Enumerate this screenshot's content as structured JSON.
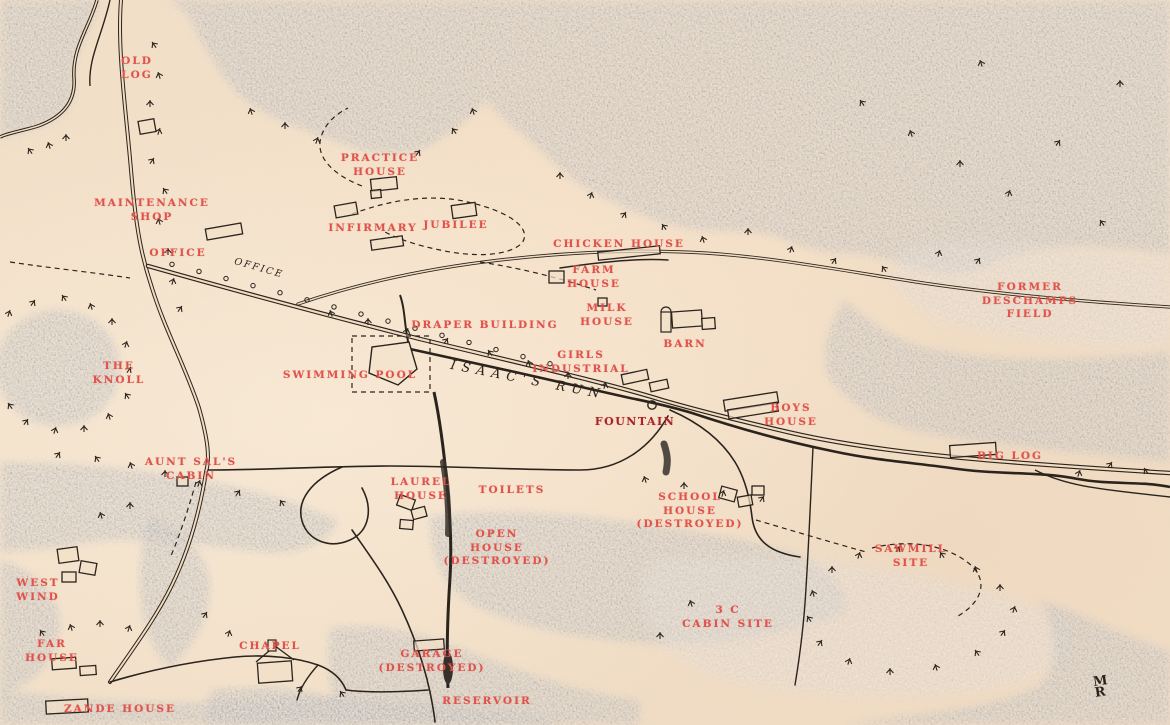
{
  "map": {
    "description": "hand-drawn settlement site map with red place labels",
    "colors": {
      "paper": "#f1dcc2",
      "forest_dark": "#8a8784",
      "forest_light": "#b9ab9c",
      "ink": "#2b241d",
      "label_red": "#e0524b",
      "strong_red": "#a8232a"
    },
    "labels": [
      {
        "text": "OLD\nLOG",
        "x": 137,
        "y": 55
      },
      {
        "text": "MAINTENANCE\nSHOP",
        "x": 152,
        "y": 197
      },
      {
        "text": "OFFICE",
        "x": 178,
        "y": 247
      },
      {
        "text": "PRACTICE\nHOUSE",
        "x": 380,
        "y": 152
      },
      {
        "text": "INFIRMARY",
        "x": 373,
        "y": 222
      },
      {
        "text": "JUBILEE",
        "x": 456,
        "y": 219
      },
      {
        "text": "CHICKEN HOUSE",
        "x": 619,
        "y": 238
      },
      {
        "text": "FARM\nHOUSE",
        "x": 594,
        "y": 264
      },
      {
        "text": "MILK\nHOUSE",
        "x": 607,
        "y": 302
      },
      {
        "text": "BARN",
        "x": 685,
        "y": 338
      },
      {
        "text": "FORMER\nDESCHAMPS\nFIELD",
        "x": 1030,
        "y": 281
      },
      {
        "text": "DRAPER BUILDING",
        "x": 485,
        "y": 319
      },
      {
        "text": "SWIMMING POOL",
        "x": 350,
        "y": 369
      },
      {
        "text": "GIRLS\nINDUSTRIAL",
        "x": 581,
        "y": 349
      },
      {
        "text": "THE\nKNOLL",
        "x": 119,
        "y": 360
      },
      {
        "text": "FOUNTAIN",
        "x": 635,
        "y": 415,
        "style": "strong"
      },
      {
        "text": "BOYS\nHOUSE",
        "x": 791,
        "y": 402
      },
      {
        "text": "BIG LOG",
        "x": 1010,
        "y": 450
      },
      {
        "text": "AUNT SAL'S\nCABIN",
        "x": 191,
        "y": 456
      },
      {
        "text": "LAUREL\nHOUSE",
        "x": 421,
        "y": 476
      },
      {
        "text": "TOILETS",
        "x": 512,
        "y": 484
      },
      {
        "text": "SCHOOL\nHOUSE\n(DESTROYED)",
        "x": 690,
        "y": 491
      },
      {
        "text": "OPEN\nHOUSE\n(DESTROYED)",
        "x": 497,
        "y": 528
      },
      {
        "text": "WEST\nWIND",
        "x": 38,
        "y": 577
      },
      {
        "text": "SAWMILL\nSITE",
        "x": 911,
        "y": 543
      },
      {
        "text": "3 C\nCABIN SITE",
        "x": 728,
        "y": 604
      },
      {
        "text": "FAR\nHOUSE",
        "x": 52,
        "y": 638
      },
      {
        "text": "CHAPEL",
        "x": 270,
        "y": 640
      },
      {
        "text": "GARAGE\n(DESTROYED)",
        "x": 432,
        "y": 648
      },
      {
        "text": "ZANDE HOUSE",
        "x": 120,
        "y": 703
      },
      {
        "text": "RESERVOIR",
        "x": 487,
        "y": 695
      }
    ],
    "handwritten": {
      "isaacs_run": {
        "text": "ISAAC'S RUN"
      },
      "office_script": {
        "text": "OFFICE"
      },
      "signature": {
        "text": "M\nR"
      }
    }
  }
}
